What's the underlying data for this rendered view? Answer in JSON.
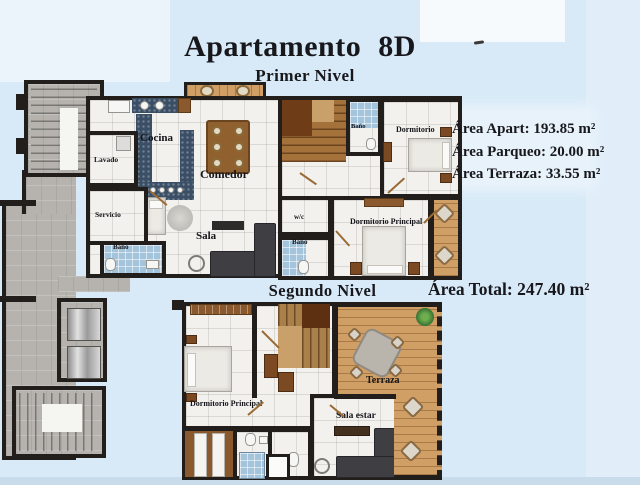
{
  "header": {
    "title": "Apartamento 8D"
  },
  "levels": {
    "first": "Primer Nivel",
    "second": "Segundo Nivel"
  },
  "areas": {
    "apart": "Área Apart: 193.85 m²",
    "parqueo": "Área Parqueo: 20.00 m²",
    "terraza": "Área Terraza: 33.55 m²",
    "total": "Área Total: 247.40 m²"
  },
  "level1": {
    "labels": {
      "cocina": "Cocina",
      "lavado": "Lavado",
      "comedor": "Comedor",
      "servicio": "Servicio",
      "bano_servicio": "Baño",
      "sala": "Sala",
      "bano_top": "Baño",
      "dormitorio": "Dormitorio",
      "wc": "w/c",
      "bano_medio": "Baño",
      "dormitorio_principal": "Dormitorio Principal"
    }
  },
  "level2": {
    "labels": {
      "dormitorio_principal": "Dormitorio Principal",
      "sala_estar": "Sala estar",
      "terraza": "Terraza"
    }
  },
  "colors": {
    "background": "#d8eaf7",
    "wall": "#221e1b",
    "stair_wood": "#a5713a",
    "terrace_deck": "#cf9f66",
    "kitchen_counter": "#3a4f66",
    "bath_tile": "#a3c4db",
    "common_gray": "#b6b3af"
  }
}
